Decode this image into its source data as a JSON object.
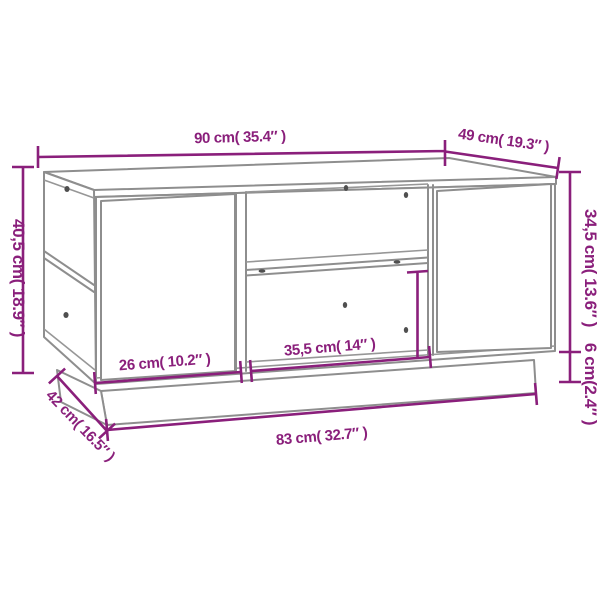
{
  "page": {
    "background_color": "#ffffff"
  },
  "diagram": {
    "kind": "furniture-dimension-diagram",
    "item": "coffee table with two doors, open middle shelf and open side shelves on plinth base",
    "accent_color": "#8a1f7b",
    "outline_color": "#8e8e8e",
    "dimensions": {
      "top_width": {
        "label": "90 cm( 35.4″ )",
        "cm": "90",
        "inches": "35.4"
      },
      "top_depth": {
        "label": "49 cm( 19.3″ )",
        "cm": "49",
        "inches": "19.3"
      },
      "overall_height": {
        "label": "40,5 cm( 18.9″ )",
        "cm": "40,5",
        "inches": "18.9"
      },
      "cabinet_height": {
        "label": "34,5 cm( 13.6″ )",
        "cm": "34,5",
        "inches": "13.6"
      },
      "plinth_height": {
        "label": "6 cm(2.4″ )",
        "cm": "6",
        "inches": "2.4"
      },
      "door_width": {
        "label": "26 cm( 10.2″ )",
        "cm": "26",
        "inches": "10.2"
      },
      "opening_width": {
        "label": "35,5 cm( 14″ )",
        "cm": "35,5",
        "inches": "14"
      },
      "plinth_width": {
        "label": "83 cm( 32.7″ )",
        "cm": "83",
        "inches": "32.7"
      },
      "plinth_depth": {
        "label": "42 cm( 16.5″ )",
        "cm": "42",
        "inches": "16.5"
      }
    }
  }
}
